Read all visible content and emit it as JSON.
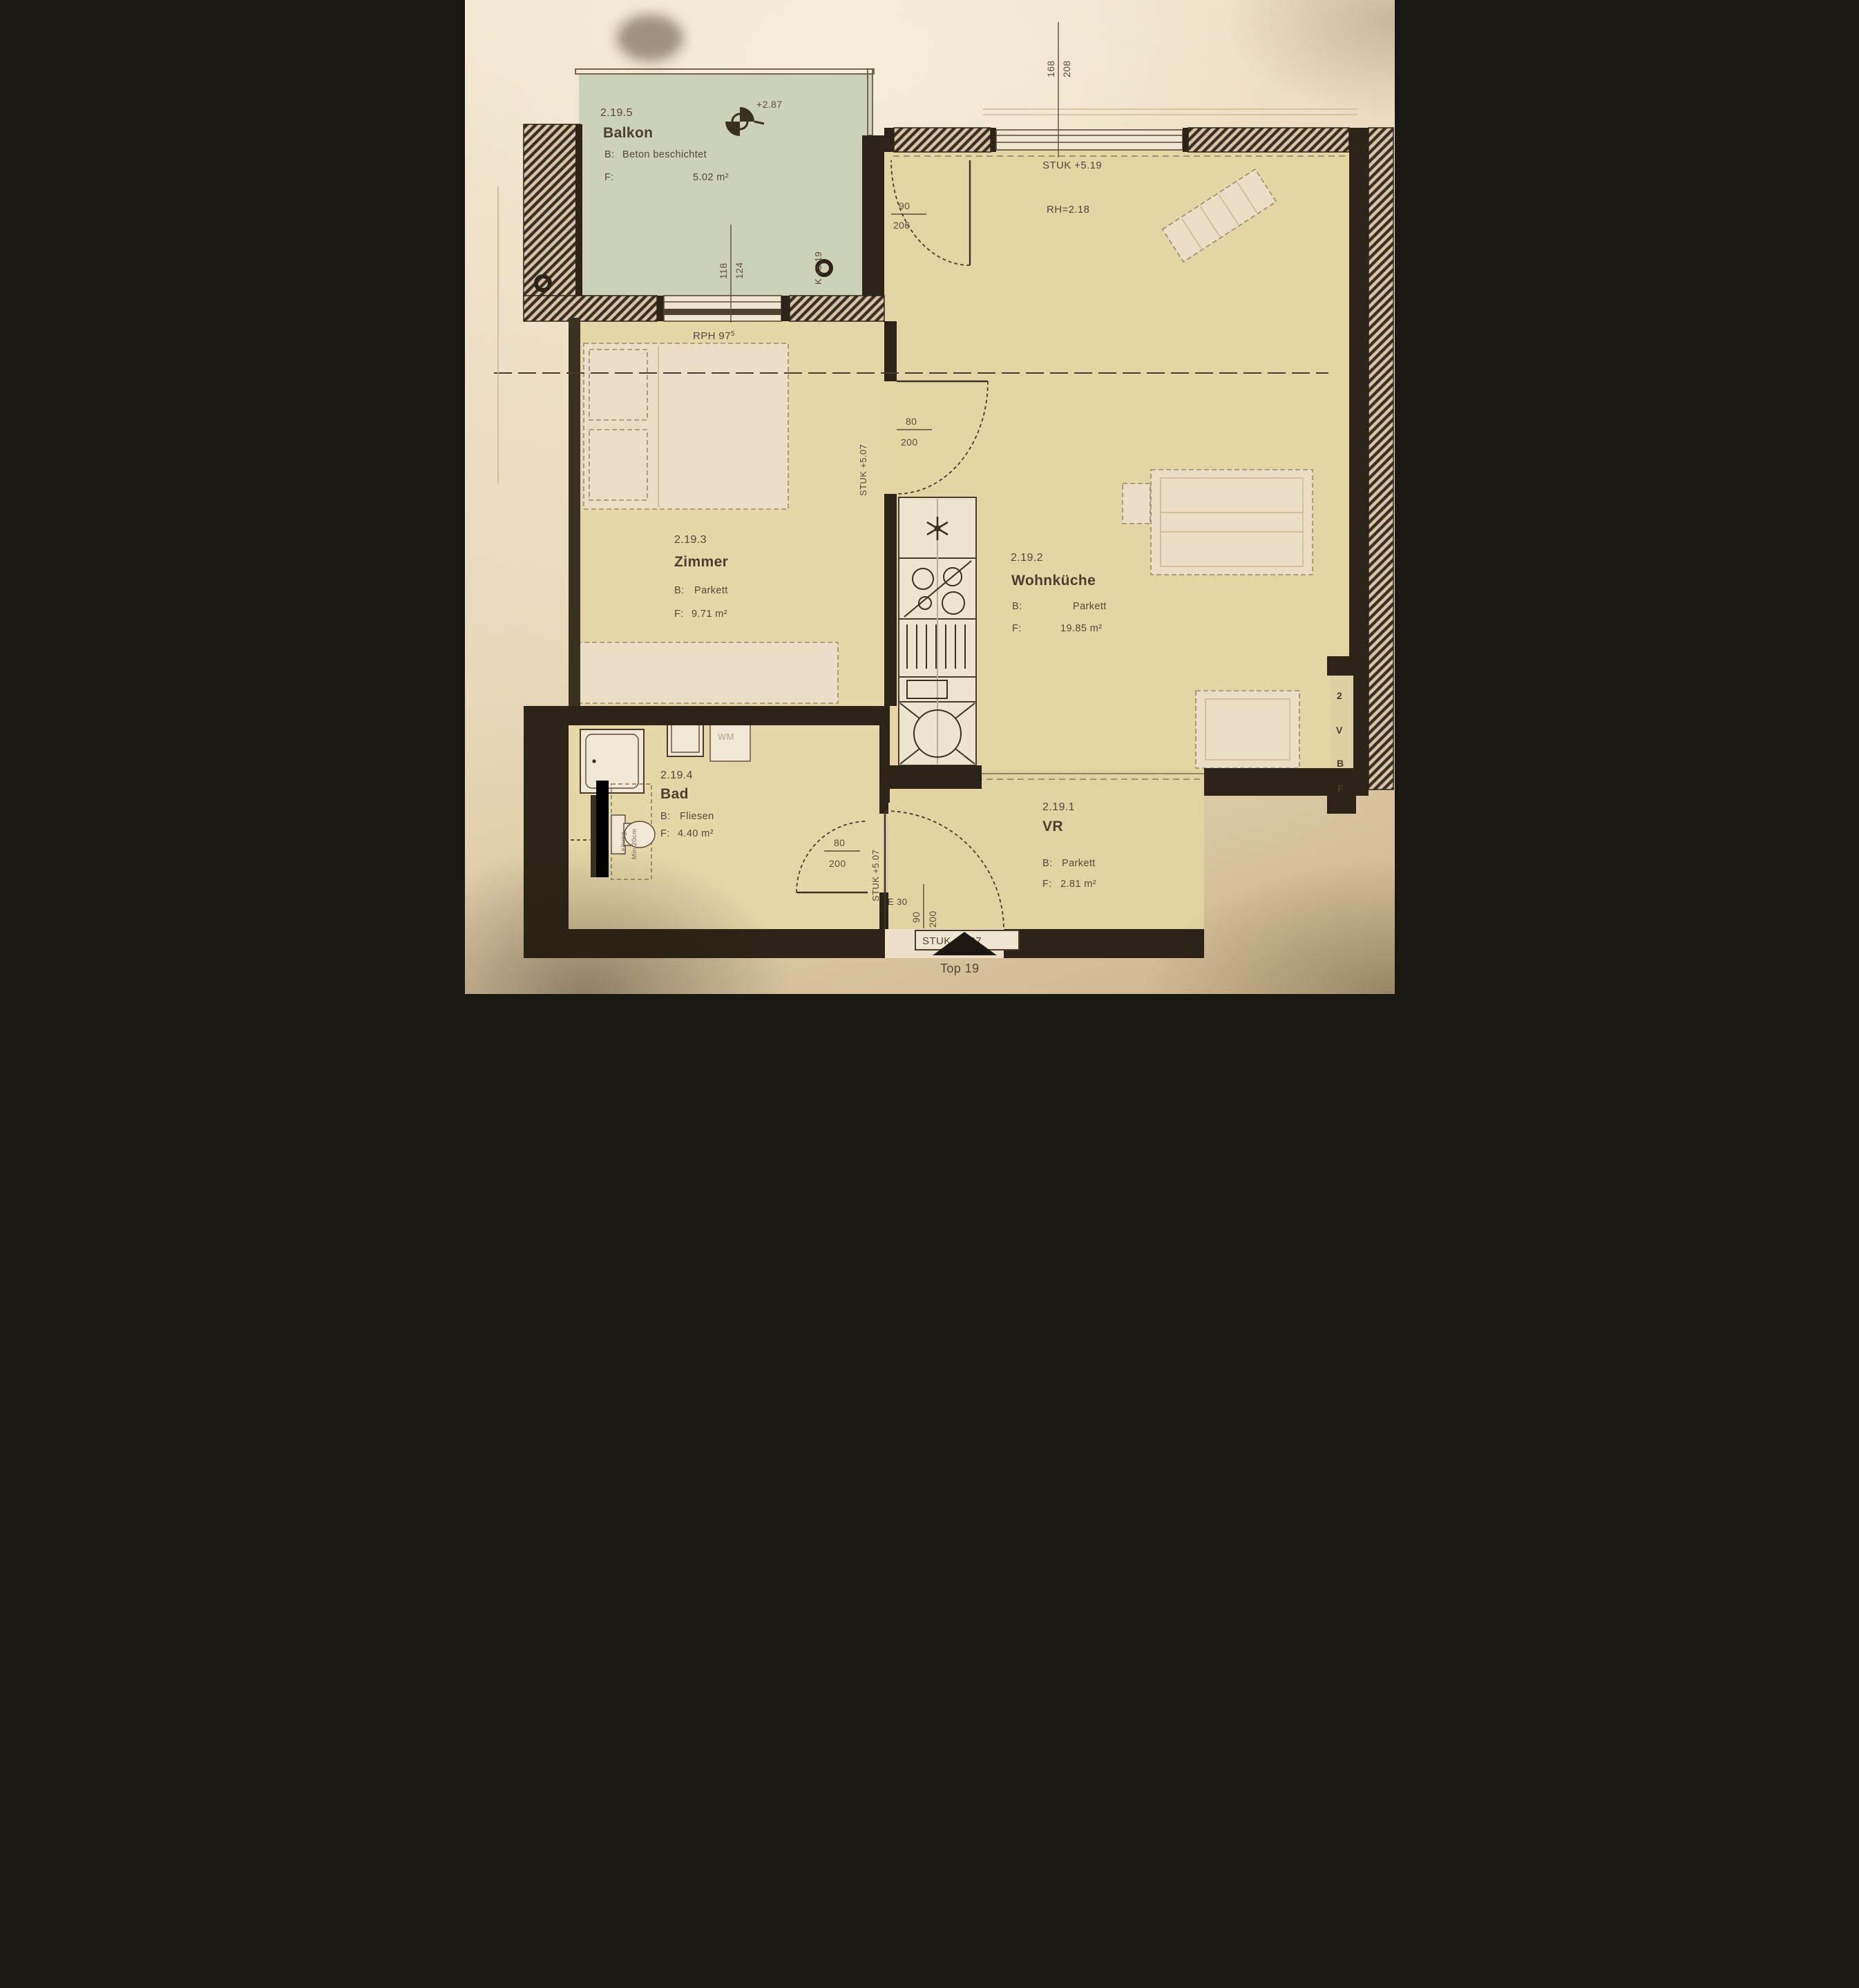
{
  "plan": {
    "rooms": {
      "balkon": {
        "number": "2.19.5",
        "name": "Balkon",
        "b_label": "B:",
        "b_value": "Beton beschichtet",
        "f_label": "F:",
        "f_value": "5.02 m²",
        "floor_color": "#cbd2b6"
      },
      "zimmer": {
        "number": "2.19.3",
        "name": "Zimmer",
        "b_label": "B:",
        "b_value": "Parkett",
        "f_label": "F:",
        "f_value": "9.71 m²",
        "floor_color": "#e4d7a8"
      },
      "wohnkueche": {
        "number": "2.19.2",
        "name": "Wohnküche",
        "b_label": "B:",
        "b_value": "Parkett",
        "f_label": "F:",
        "f_value": "19.85 m²",
        "floor_color": "#e4d6a4"
      },
      "bad": {
        "number": "2.19.4",
        "name": "Bad",
        "b_label": "B:",
        "b_value": "Fliesen",
        "f_label": "F:",
        "f_value": "4.40 m²",
        "floor_color": "#e4d7a8"
      },
      "vr": {
        "number": "2.19.1",
        "name": "VR",
        "b_label": "B:",
        "b_value": "Parkett",
        "f_label": "F:",
        "f_value": "2.81 m²",
        "floor_color": "#e2d4a2"
      }
    },
    "dimensions": {
      "balcony_door": {
        "width": "90",
        "height": "206"
      },
      "zimmer_door": {
        "width": "80",
        "height": "200"
      },
      "bad_door": {
        "width": "80",
        "height": "200"
      },
      "entrance_door": {
        "width": "90",
        "height": "200"
      },
      "balcony_window": {
        "width": "118",
        "height": "124"
      },
      "main_window": {
        "width": "168",
        "height": "208"
      }
    },
    "annotations": {
      "level_balcony": "+2.87",
      "stuk_window": "STUK +5.19",
      "room_height": "RH=2.18",
      "rph_base": "RPH 97",
      "rph_sup": "5",
      "k_level": "K +5.19",
      "stuk_zimmer_door": "STUK +5.07",
      "stuk_bad_door": "STUK +5.07",
      "stuk_entrance": "STUK +5.07",
      "fire_rating": "E 30",
      "washing_machine": "WM",
      "wc_note_1": "Leitung",
      "wc_note_2": "Min 20cm",
      "shaft": [
        "2",
        "V",
        "B",
        "F"
      ],
      "entrance_label": "Top 19"
    },
    "colors": {
      "wall": "#2c2418",
      "paper": "#e8dabc"
    }
  }
}
